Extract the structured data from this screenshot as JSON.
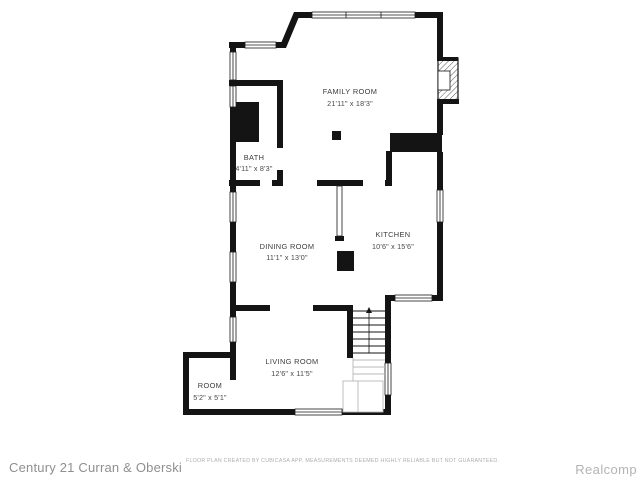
{
  "page": {
    "background": "#ffffff"
  },
  "floor_plan": {
    "wall_color": "#141414",
    "label_color": "#3c3c3c",
    "stair_light_color": "#b8b8b8",
    "rooms": [
      {
        "id": "family-room",
        "name": "FAMILY ROOM",
        "dimensions": "21'11\" x 18'3\""
      },
      {
        "id": "bath",
        "name": "BATH",
        "dimensions": "4'11\" x 8'3\""
      },
      {
        "id": "dining-room",
        "name": "DINING ROOM",
        "dimensions": "11'1\" x 13'0\""
      },
      {
        "id": "kitchen",
        "name": "KITCHEN",
        "dimensions": "10'6\" x 15'6\""
      },
      {
        "id": "living-room",
        "name": "LIVING ROOM",
        "dimensions": "12'6\" x 11'5\""
      },
      {
        "id": "room",
        "name": "ROOM",
        "dimensions": "5'2\" x 5'1\""
      }
    ],
    "features": [
      "fireplace",
      "staircase",
      "chimney",
      "bay-corner",
      "windows"
    ]
  },
  "footer": {
    "agency": "Century 21 Curran & Oberski",
    "disclaimer": "FLOOR PLAN CREATED BY CUBICASA APP. MEASUREMENTS DEEMED HIGHLY RELIABLE BUT NOT GUARANTEED.",
    "provider": "Realcomp"
  }
}
